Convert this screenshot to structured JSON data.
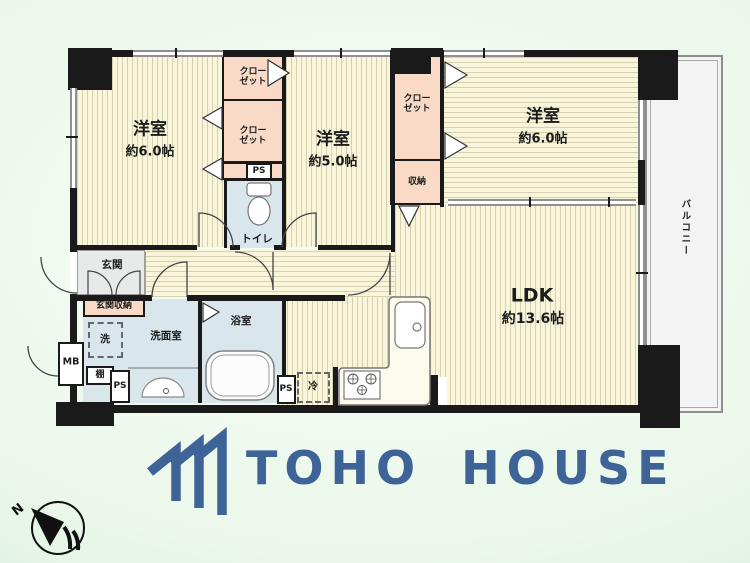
{
  "plan": {
    "room1": {
      "name": "洋室",
      "size": "約6.0帖"
    },
    "room2": {
      "name": "洋室",
      "size": "約5.0帖"
    },
    "room3": {
      "name": "洋室",
      "size": "約6.0帖"
    },
    "ldk": {
      "name": "LDK",
      "size": "約13.6帖"
    },
    "labels": {
      "closet": "クロー\nゼット",
      "storage": "収納",
      "toilet": "トイレ",
      "entrance": "玄関",
      "entrance_storage": "玄関収納",
      "washroom": "洗面室",
      "bathroom": "浴室",
      "washer": "洗",
      "fridge": "冷",
      "shelf": "棚",
      "pipe_space": "PS",
      "meter_box": "MB",
      "balcony": "バルコニー"
    }
  },
  "compass": {
    "north_label": "N"
  },
  "branding": {
    "logo_text": "TOHO HOUSE",
    "logo_color": "#3d6397"
  },
  "colors": {
    "wall": "#1a1a1a",
    "room_floor": "#f8f5da",
    "floor_stripe": "#d6d2b0",
    "wet_room": "#d9e7ec",
    "closet": "#f8dac6",
    "entrance": "#e8eaea",
    "balcony": "#f3f3f3",
    "background": "#ddeedd"
  }
}
